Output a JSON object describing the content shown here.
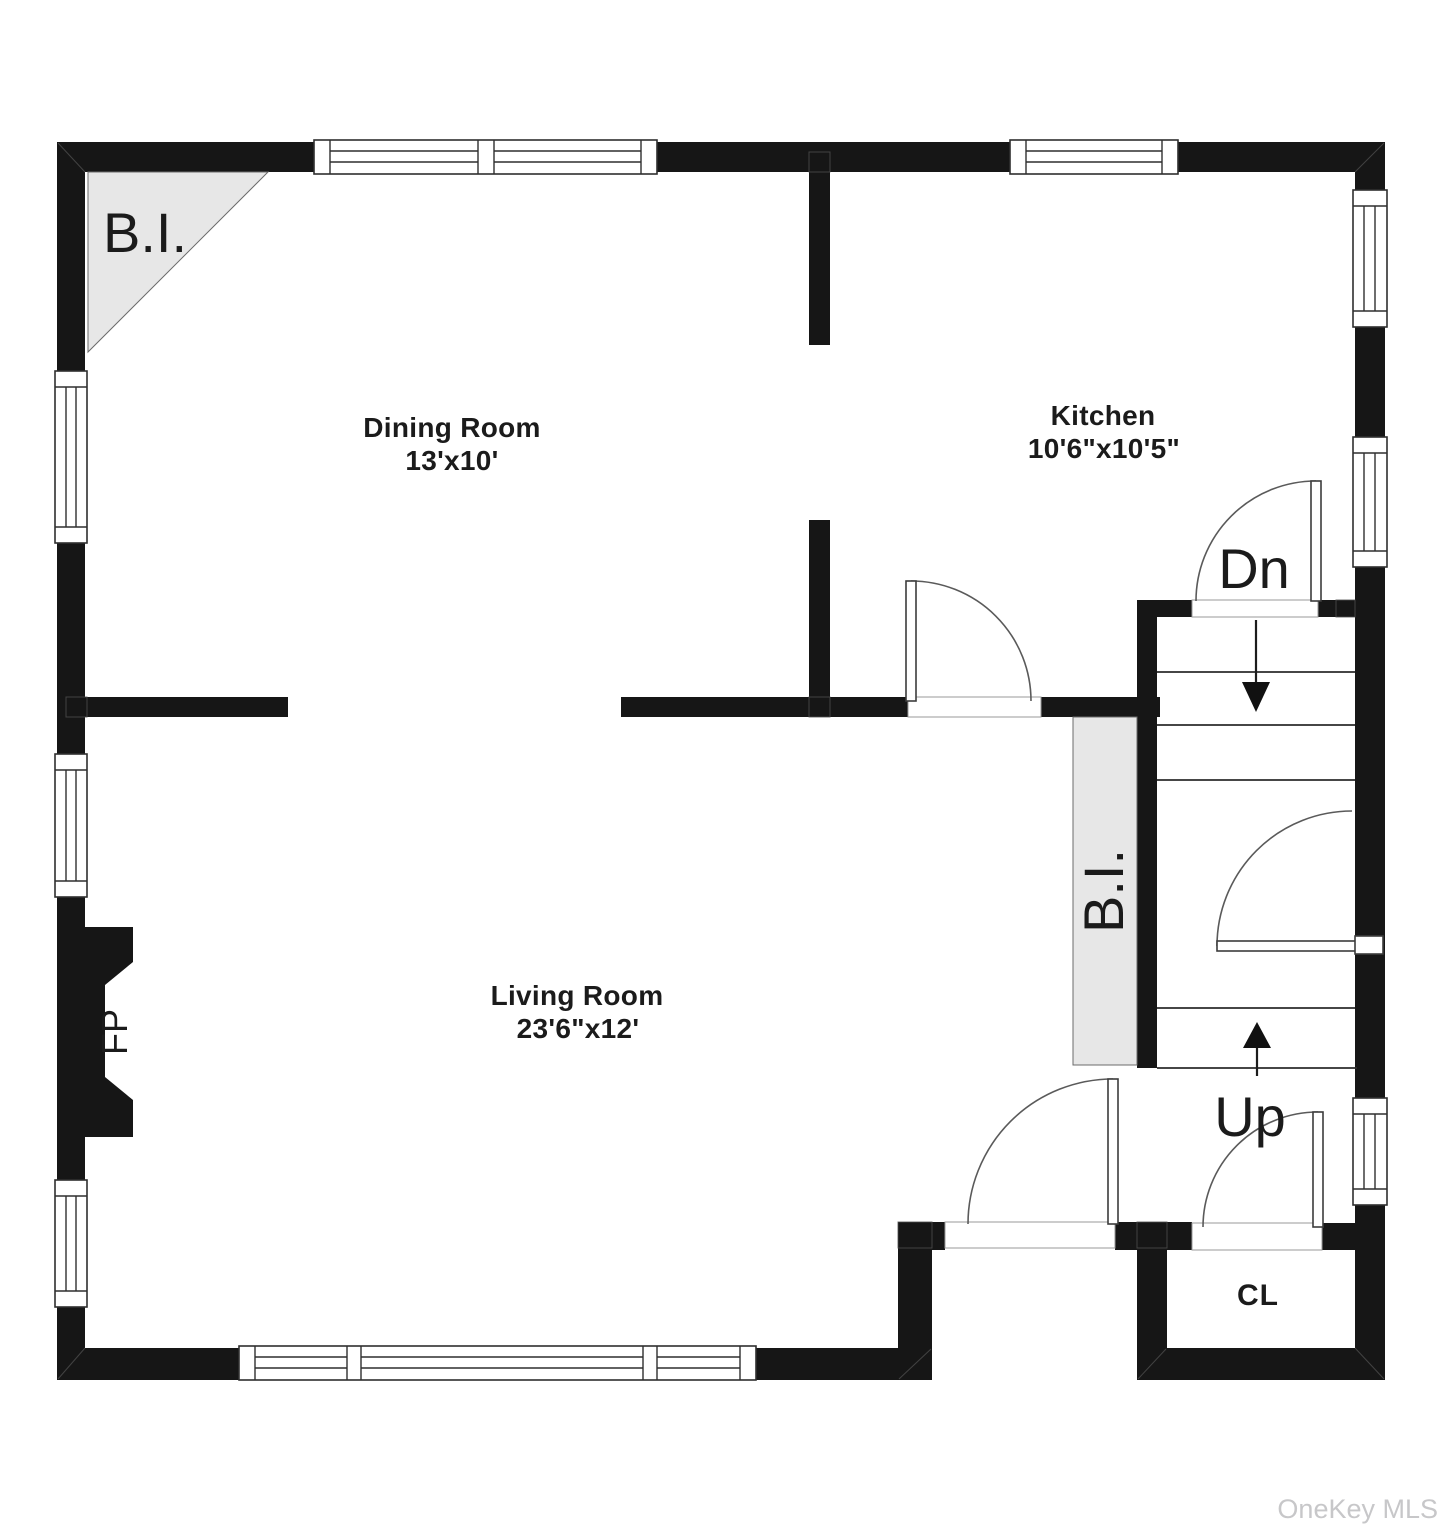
{
  "floorplan": {
    "rooms": [
      {
        "id": "dining",
        "name": "Dining Room",
        "dims": "13'x10'"
      },
      {
        "id": "kitchen",
        "name": "Kitchen",
        "dims": "10'6\"x10'5\""
      },
      {
        "id": "living",
        "name": "Living Room",
        "dims": "23'6\"x12'"
      }
    ],
    "annotations": {
      "builtin_corner": "B.I.",
      "builtin_hall": "B.I.",
      "fireplace": "FP",
      "stairs_down": "Dn",
      "stairs_up": "Up",
      "closet": "CL"
    },
    "colors": {
      "wall": "#161616",
      "builtin_fill": "#e7e7e7",
      "line": "#2f2f2f",
      "watermark": "#c7c7c9"
    },
    "watermark": "OneKey MLS"
  }
}
